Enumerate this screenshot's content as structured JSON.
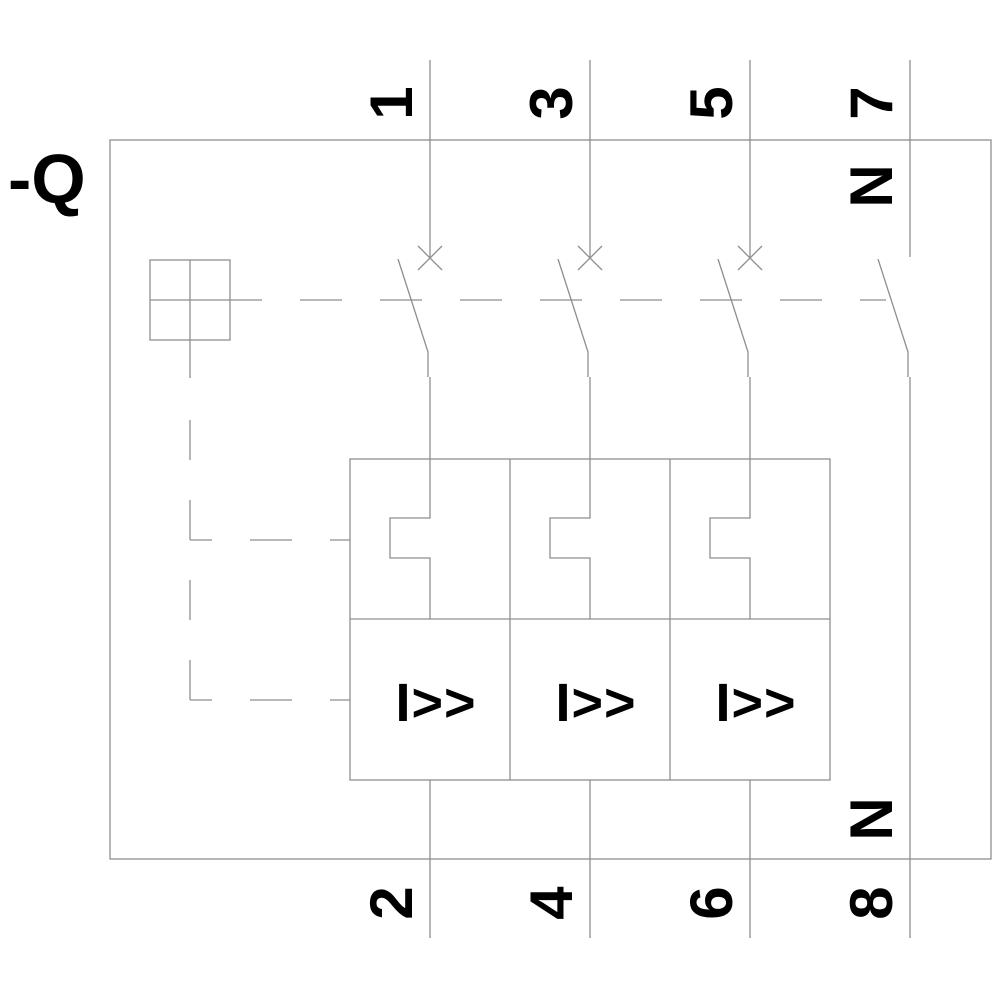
{
  "device_label": "-Q",
  "colors": {
    "line": "#8f8f8f",
    "text": "#000000",
    "background": "#ffffff"
  },
  "poles": [
    {
      "top_terminal": "1",
      "bottom_terminal": "2",
      "trip_label": "I>>"
    },
    {
      "top_terminal": "3",
      "bottom_terminal": "4",
      "trip_label": "I>>"
    },
    {
      "top_terminal": "5",
      "bottom_terminal": "6",
      "trip_label": "I>>"
    },
    {
      "top_terminal": "7",
      "bottom_terminal": "8",
      "top_neutral_label": "N",
      "bottom_neutral_label": "N"
    }
  ]
}
